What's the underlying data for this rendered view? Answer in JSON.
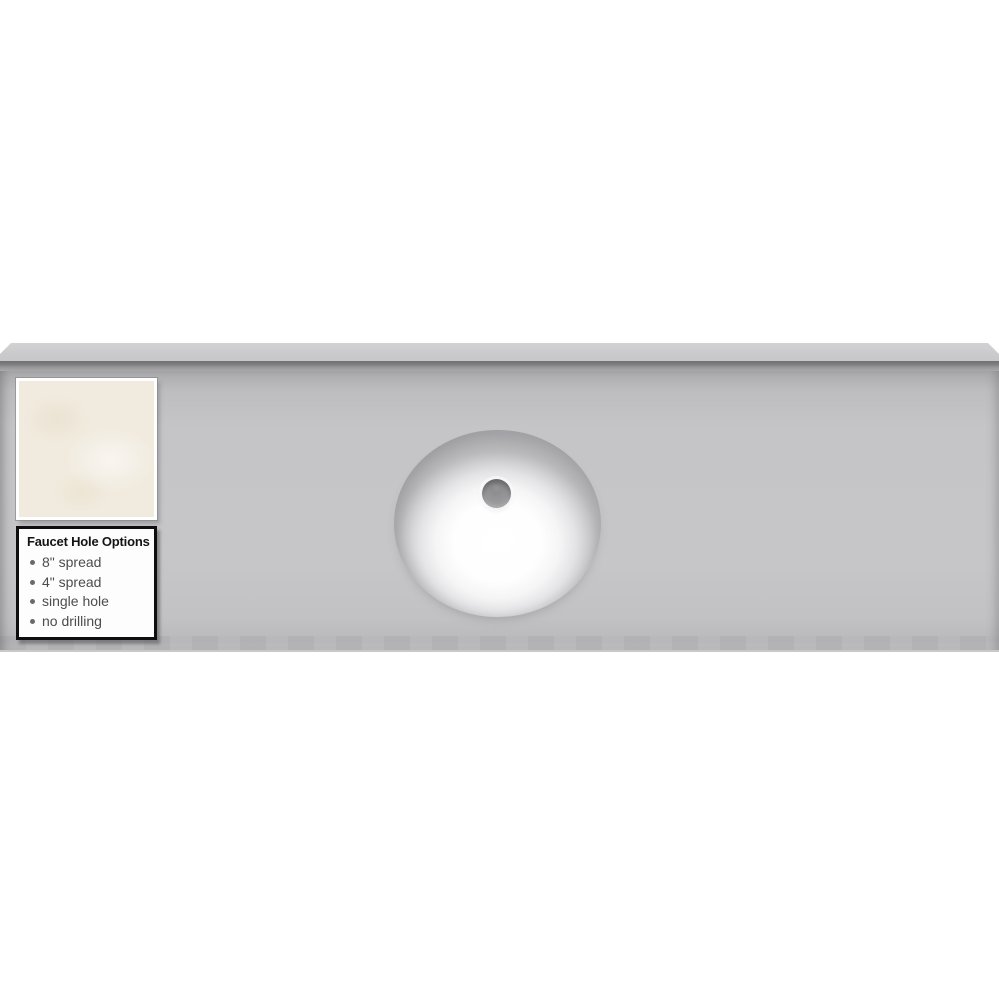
{
  "product_image": {
    "subject": "vanity-countertop-with-oval-sink",
    "colors": {
      "background": "#ffffff",
      "countertop_surface": "#c6c6c8",
      "countertop_edge": "#cbcbcd",
      "countertop_seam": "#707073",
      "sink_basin": "#ffffff",
      "drain": "#9a9a9c",
      "swatch": "#f1ebdf",
      "panel_border": "#0e0e0e",
      "panel_text": "#4c4c4e"
    }
  },
  "faucet_options": {
    "title": "Faucet Hole Options",
    "items": [
      "8\" spread",
      "4\" spread",
      "single hole",
      "no drilling"
    ]
  }
}
